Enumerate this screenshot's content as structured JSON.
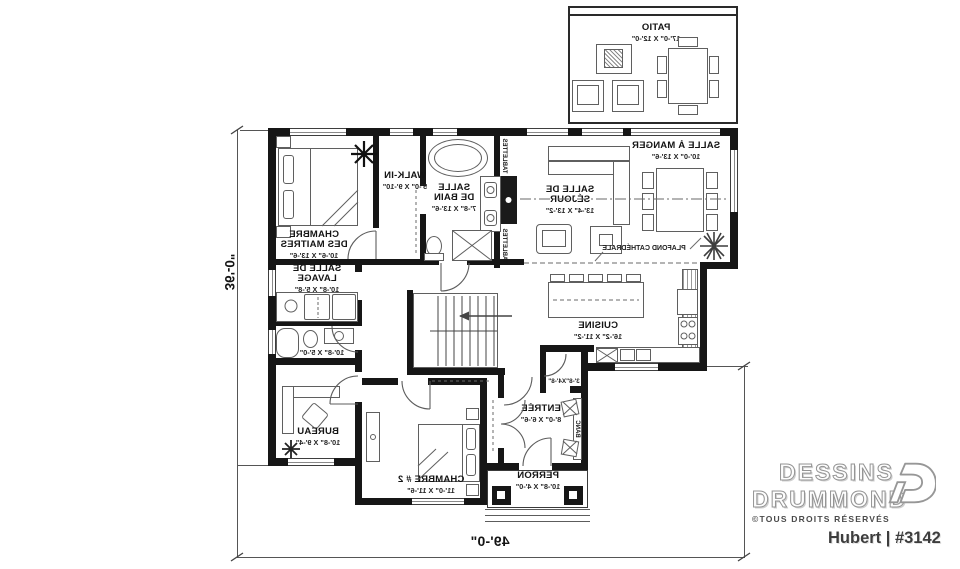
{
  "branding": {
    "line1": "DESSINS",
    "line2": "DRUMMOND",
    "rights": "©TOUS DROITS RÉSERVÉS",
    "plan": "Hubert | #3142"
  },
  "dims": {
    "width": "49'-0\"",
    "depth": "36'-0\""
  },
  "rooms": {
    "patio": {
      "name": "PATIO",
      "size": "17'-0\" X 12'-0\""
    },
    "master": {
      "name": "CHAMBRE\nDES MAITRES",
      "size": "10'-6\" X 13'-6\""
    },
    "walkin": {
      "name": "WALK-IN",
      "size": "5'-0\" X 9'-10\""
    },
    "bain": {
      "name": "SALLE\nDE BAIN",
      "size": "7'-8\" X 13'-6\""
    },
    "sejour": {
      "name": "SALLE DE\nSÉJOUR",
      "size": "13'-4\" X 13'-2\""
    },
    "manger": {
      "name": "SALLE À MANGER",
      "size": "10'-0\" X 13'-6\""
    },
    "cuisine": {
      "name": "CUISINE",
      "size": "16'-2\" X 11'-2\""
    },
    "lavage": {
      "name": "SALLE DE LAVAGE",
      "size": "10'-8\" X 5'-8\""
    },
    "bain2": {
      "size": "10'-8\" X 5'-0\""
    },
    "bureau": {
      "name": "BUREAU",
      "size": "10'-8\" X 9'-4\""
    },
    "chambre2": {
      "name": "CHAMBRE # 2",
      "size": "11'-0\" X 11'-6\""
    },
    "entree": {
      "name": "ENTRÉE",
      "size": "8'-0\" X 6'-6\""
    },
    "rangement": {
      "size": "3'-8\"X4'-8\""
    },
    "perron": {
      "name": "PERRON",
      "size": "10'-8\" X 4'-0\""
    }
  },
  "notes": {
    "plafond": "PLAFOND CATHÉDRALE",
    "banc": "BANC",
    "tablettes1": "TABLETTES",
    "tablettes2": "TABLETTES"
  },
  "colors": {
    "wall": "#161616",
    "line": "#5f5f5f",
    "text": "#141414"
  }
}
